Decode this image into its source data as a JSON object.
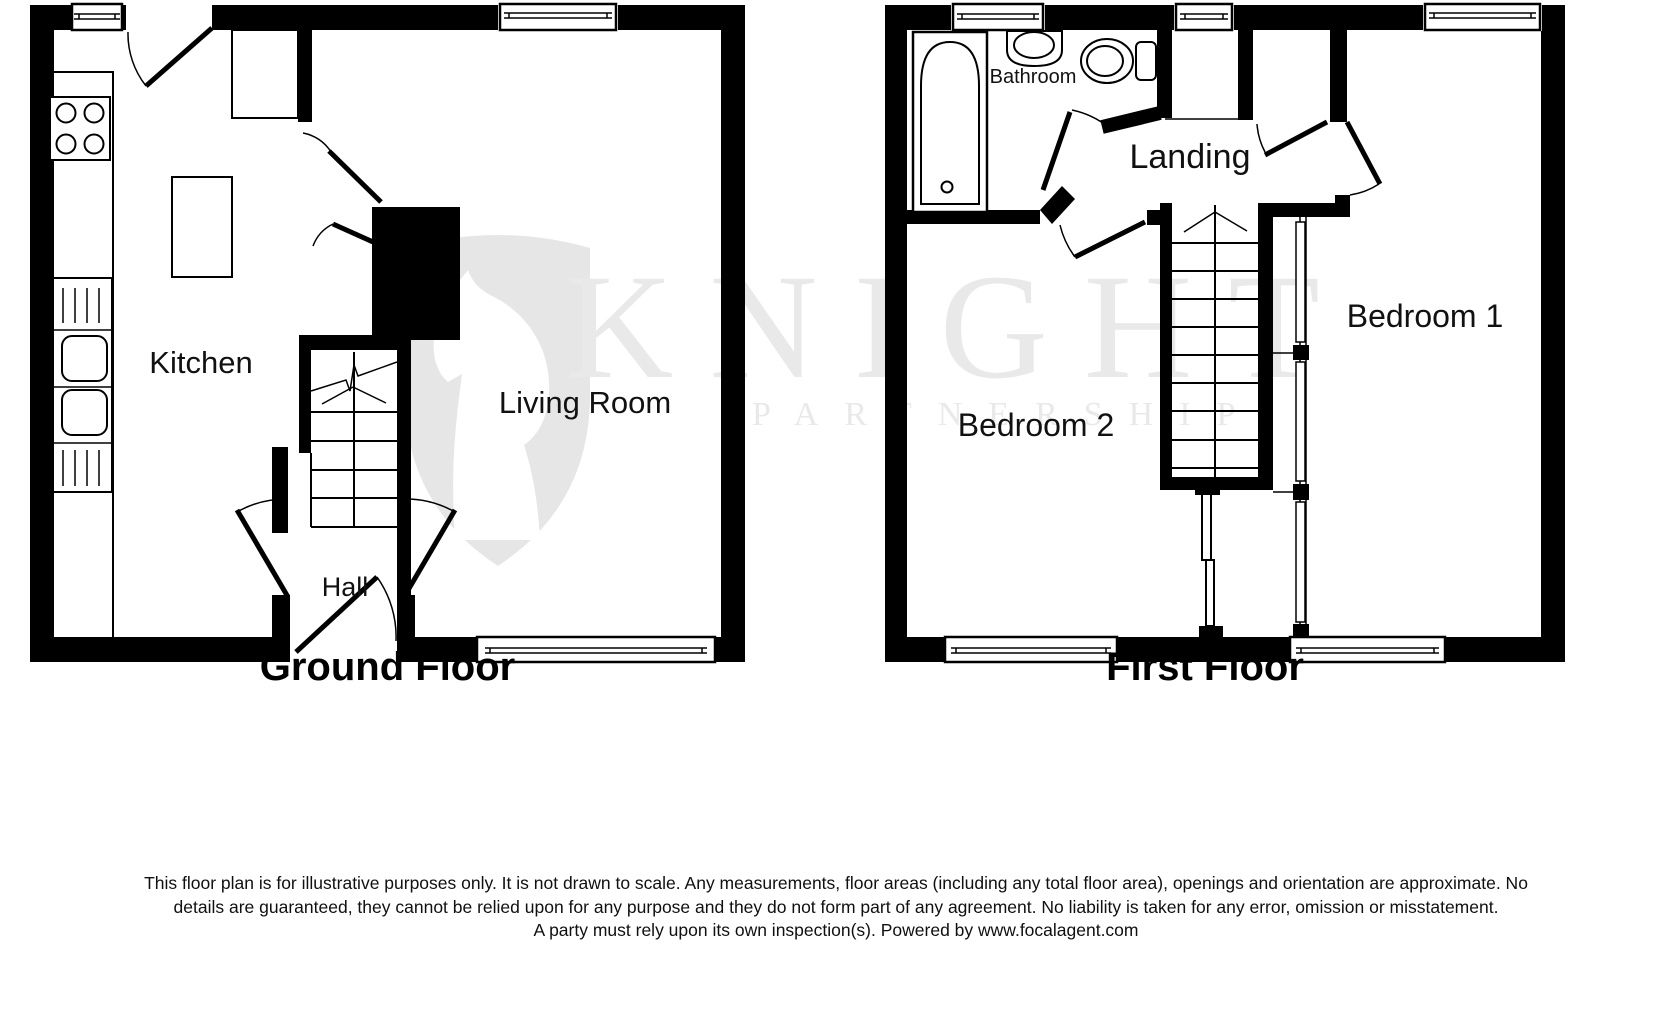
{
  "watermark": {
    "brand": "KNIGHT",
    "sub": "PARTNERSHIP",
    "text_color": "#e9e9e9",
    "shield_color": "#e6e6e6",
    "shield_icon": "knight-chess-shield"
  },
  "floors": [
    {
      "title": "Ground Floor",
      "rooms": [
        {
          "label": "Kitchen"
        },
        {
          "label": "Living Room"
        },
        {
          "label": "Hall"
        }
      ],
      "fixture_icons": [
        "hob-icon",
        "sink-drainer-icon",
        "staircase-icon"
      ]
    },
    {
      "title": "First Floor",
      "rooms": [
        {
          "label": "Bathroom"
        },
        {
          "label": "Landing"
        },
        {
          "label": "Bedroom 2"
        },
        {
          "label": "Bedroom 1"
        }
      ],
      "fixture_icons": [
        "bathtub-icon",
        "basin-icon",
        "toilet-icon",
        "staircase-icon",
        "wardrobe-icon"
      ]
    }
  ],
  "disclaimer": {
    "line1": "This floor plan is for illustrative purposes only. It is not drawn to scale. Any measurements, floor areas (including any total floor area), openings and orientation are approximate. No",
    "line2": "details are guaranteed, they cannot be relied upon for any purpose and they do not form part of any agreement. No liability is taken for any error, omission or misstatement.",
    "line3": "A party must rely upon its own inspection(s). Powered by www.focalagent.com"
  },
  "colors": {
    "walls": "#000000",
    "background": "#ffffff",
    "label_text": "#111111"
  }
}
